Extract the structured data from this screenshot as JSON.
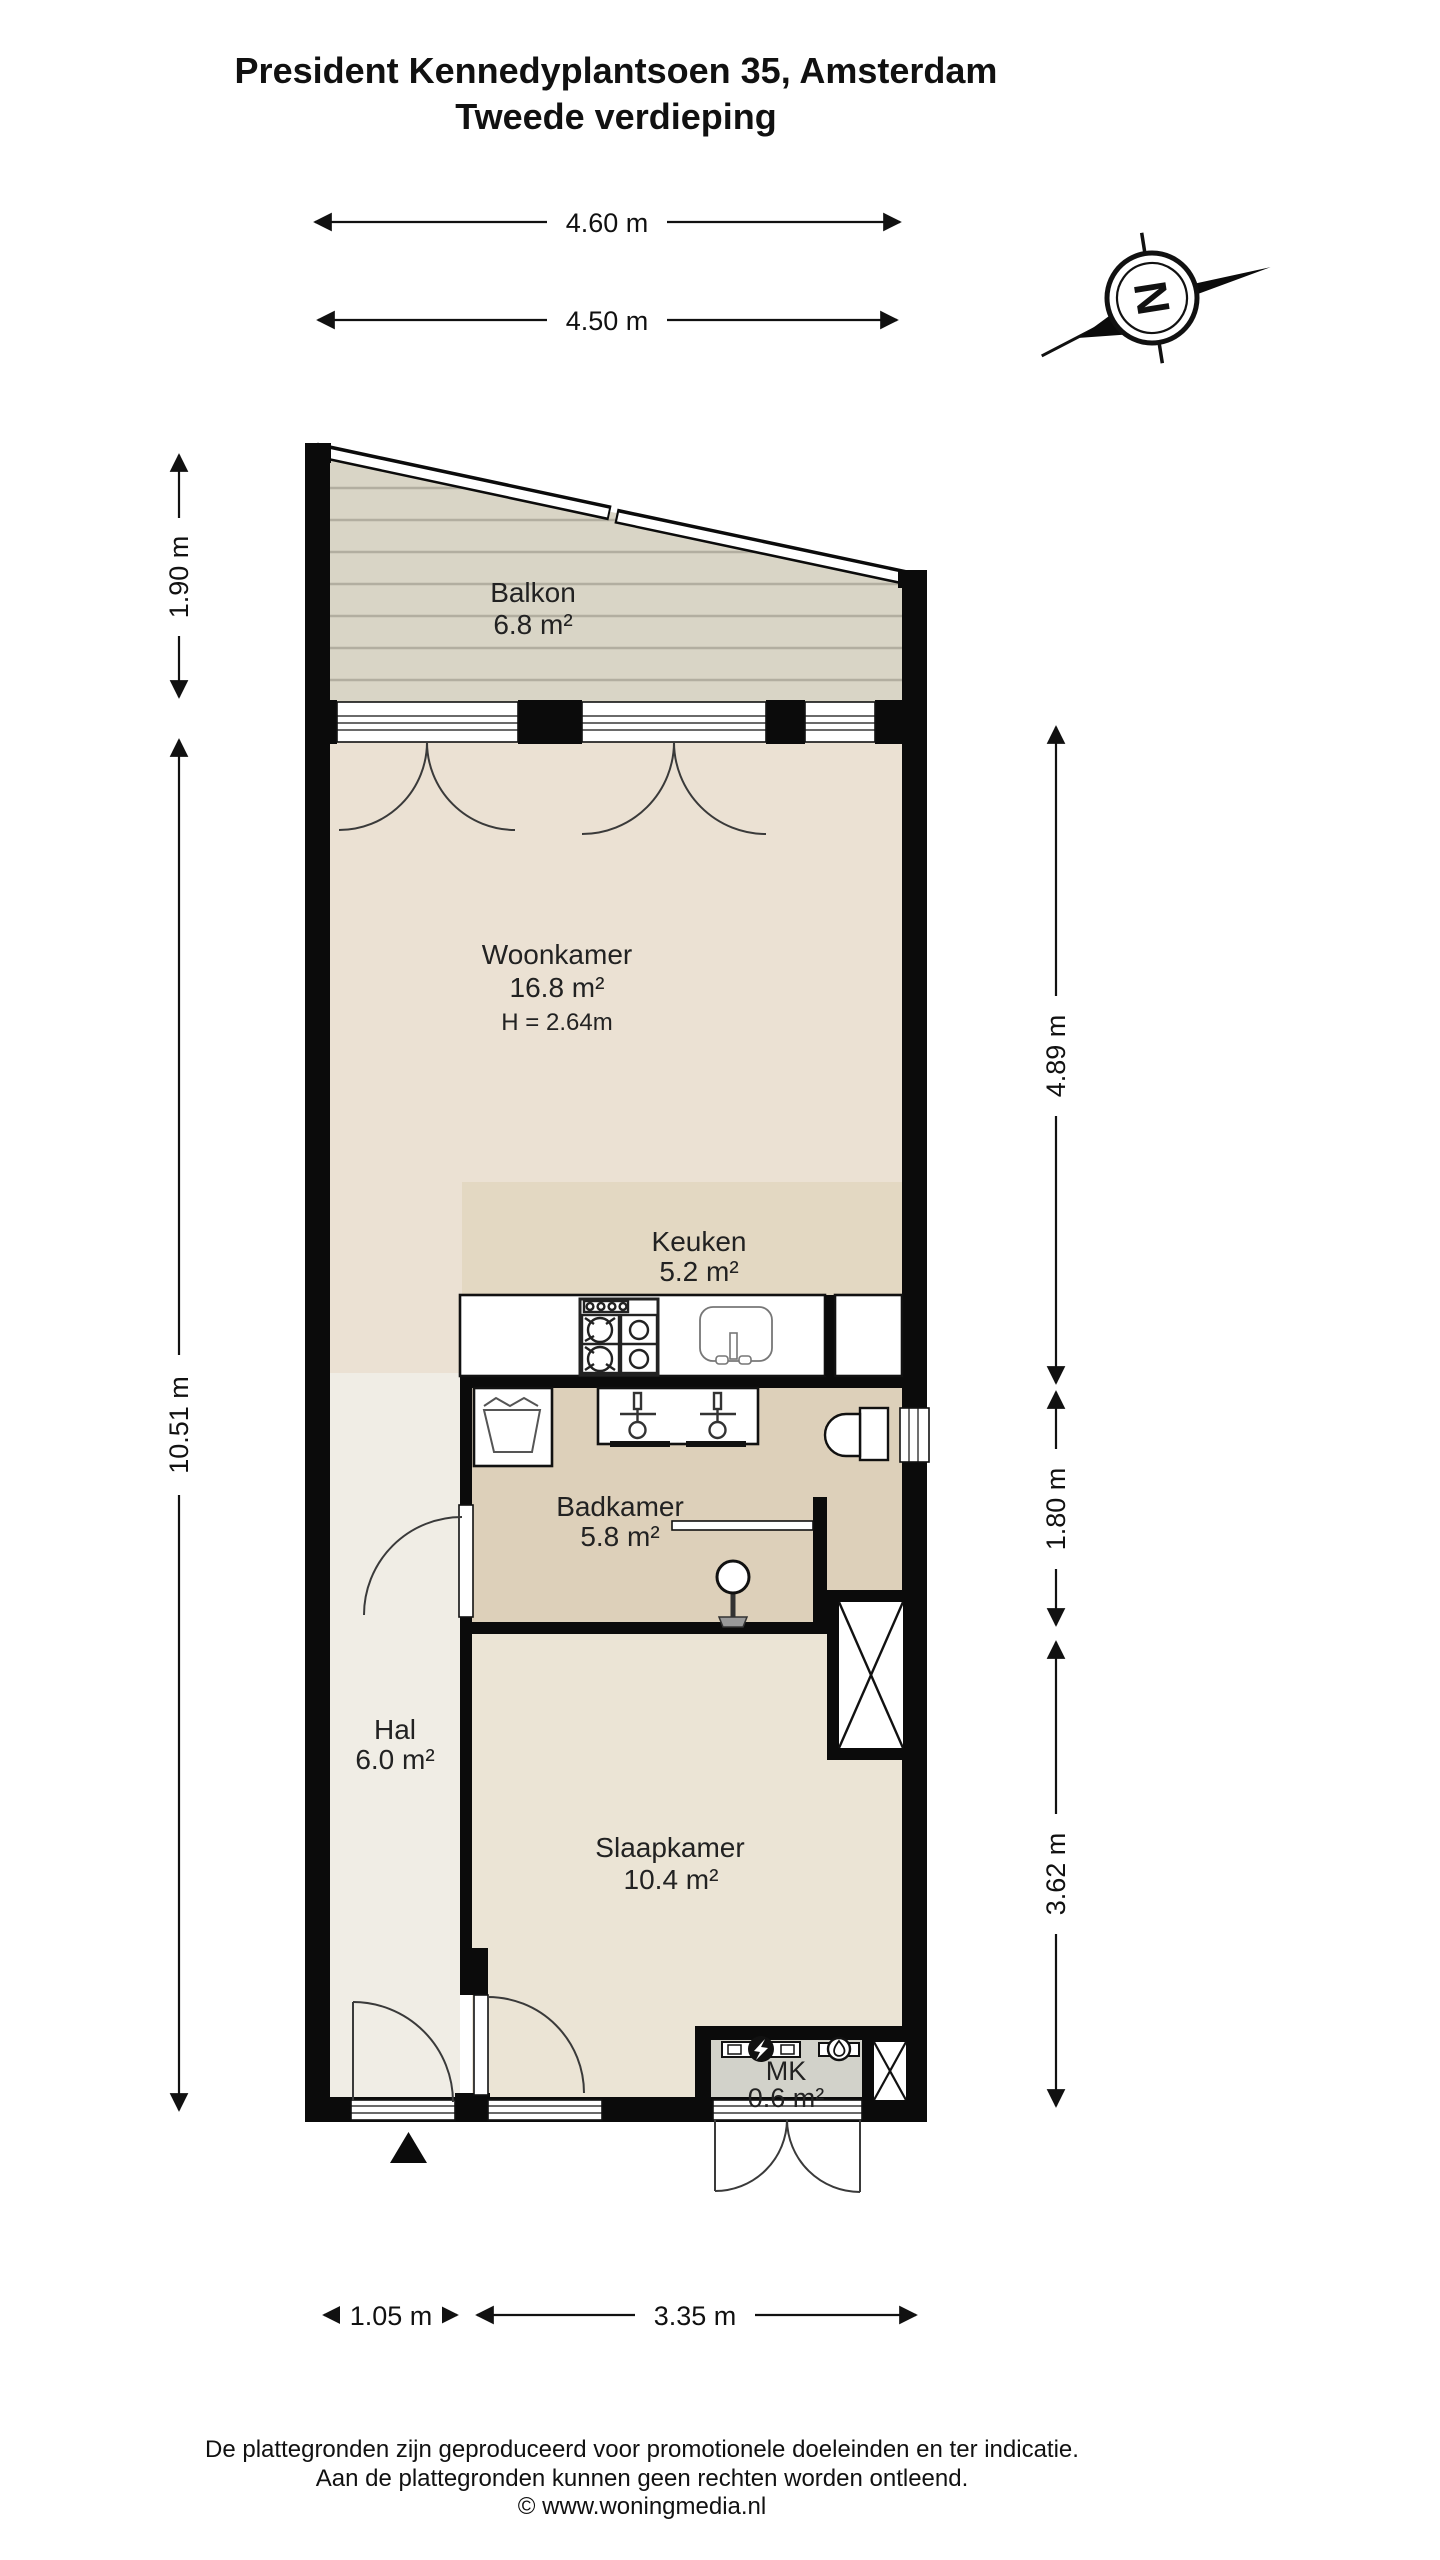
{
  "title": {
    "line1": "President Kennedyplantsoen 35, Amsterdam",
    "line2": "Tweede verdieping"
  },
  "compass": {
    "letter": "N"
  },
  "rooms": {
    "balkon": {
      "name": "Balkon",
      "area": "6.8 m²"
    },
    "woonkamer": {
      "name": "Woonkamer",
      "area": "16.8 m²",
      "height": "H = 2.64m"
    },
    "keuken": {
      "name": "Keuken",
      "area": "5.2 m²"
    },
    "badkamer": {
      "name": "Badkamer",
      "area": "5.8 m²"
    },
    "hal": {
      "name": "Hal",
      "area": "6.0 m²"
    },
    "slaapkamer": {
      "name": "Slaapkamer",
      "area": "10.4 m²"
    },
    "mk": {
      "name": "MK",
      "area": "0.6 m²"
    }
  },
  "dimensions": {
    "top_outer": "4.60 m",
    "top_inner": "4.50 m",
    "left_balcony": "1.90 m",
    "left_main": "10.51 m",
    "right_upper": "4.89 m",
    "right_middle": "1.80 m",
    "right_lower": "3.62 m",
    "bottom_left": "1.05 m",
    "bottom_right": "3.35 m"
  },
  "footer": {
    "line1": "De plattegronden zijn geproduceerd voor promotionele doeleinden en ter indicatie.",
    "line2": "Aan de plattegronden kunnen geen rechten worden ontleend.",
    "line3": "© www.woningmedia.nl"
  },
  "colors": {
    "wall": "#0b0b0b",
    "floor_living": "#ebe1d3",
    "floor_kitchen": "#e3d8c2",
    "floor_bathroom": "#ddd0ba",
    "floor_hall": "#f0ede5",
    "floor_bedroom": "#ebe4d5",
    "floor_balcony": "#d9d5c6",
    "balcony_stripe": "#b9b5a7",
    "mk_fill": "#d2d2ca",
    "background": "#ffffff"
  }
}
